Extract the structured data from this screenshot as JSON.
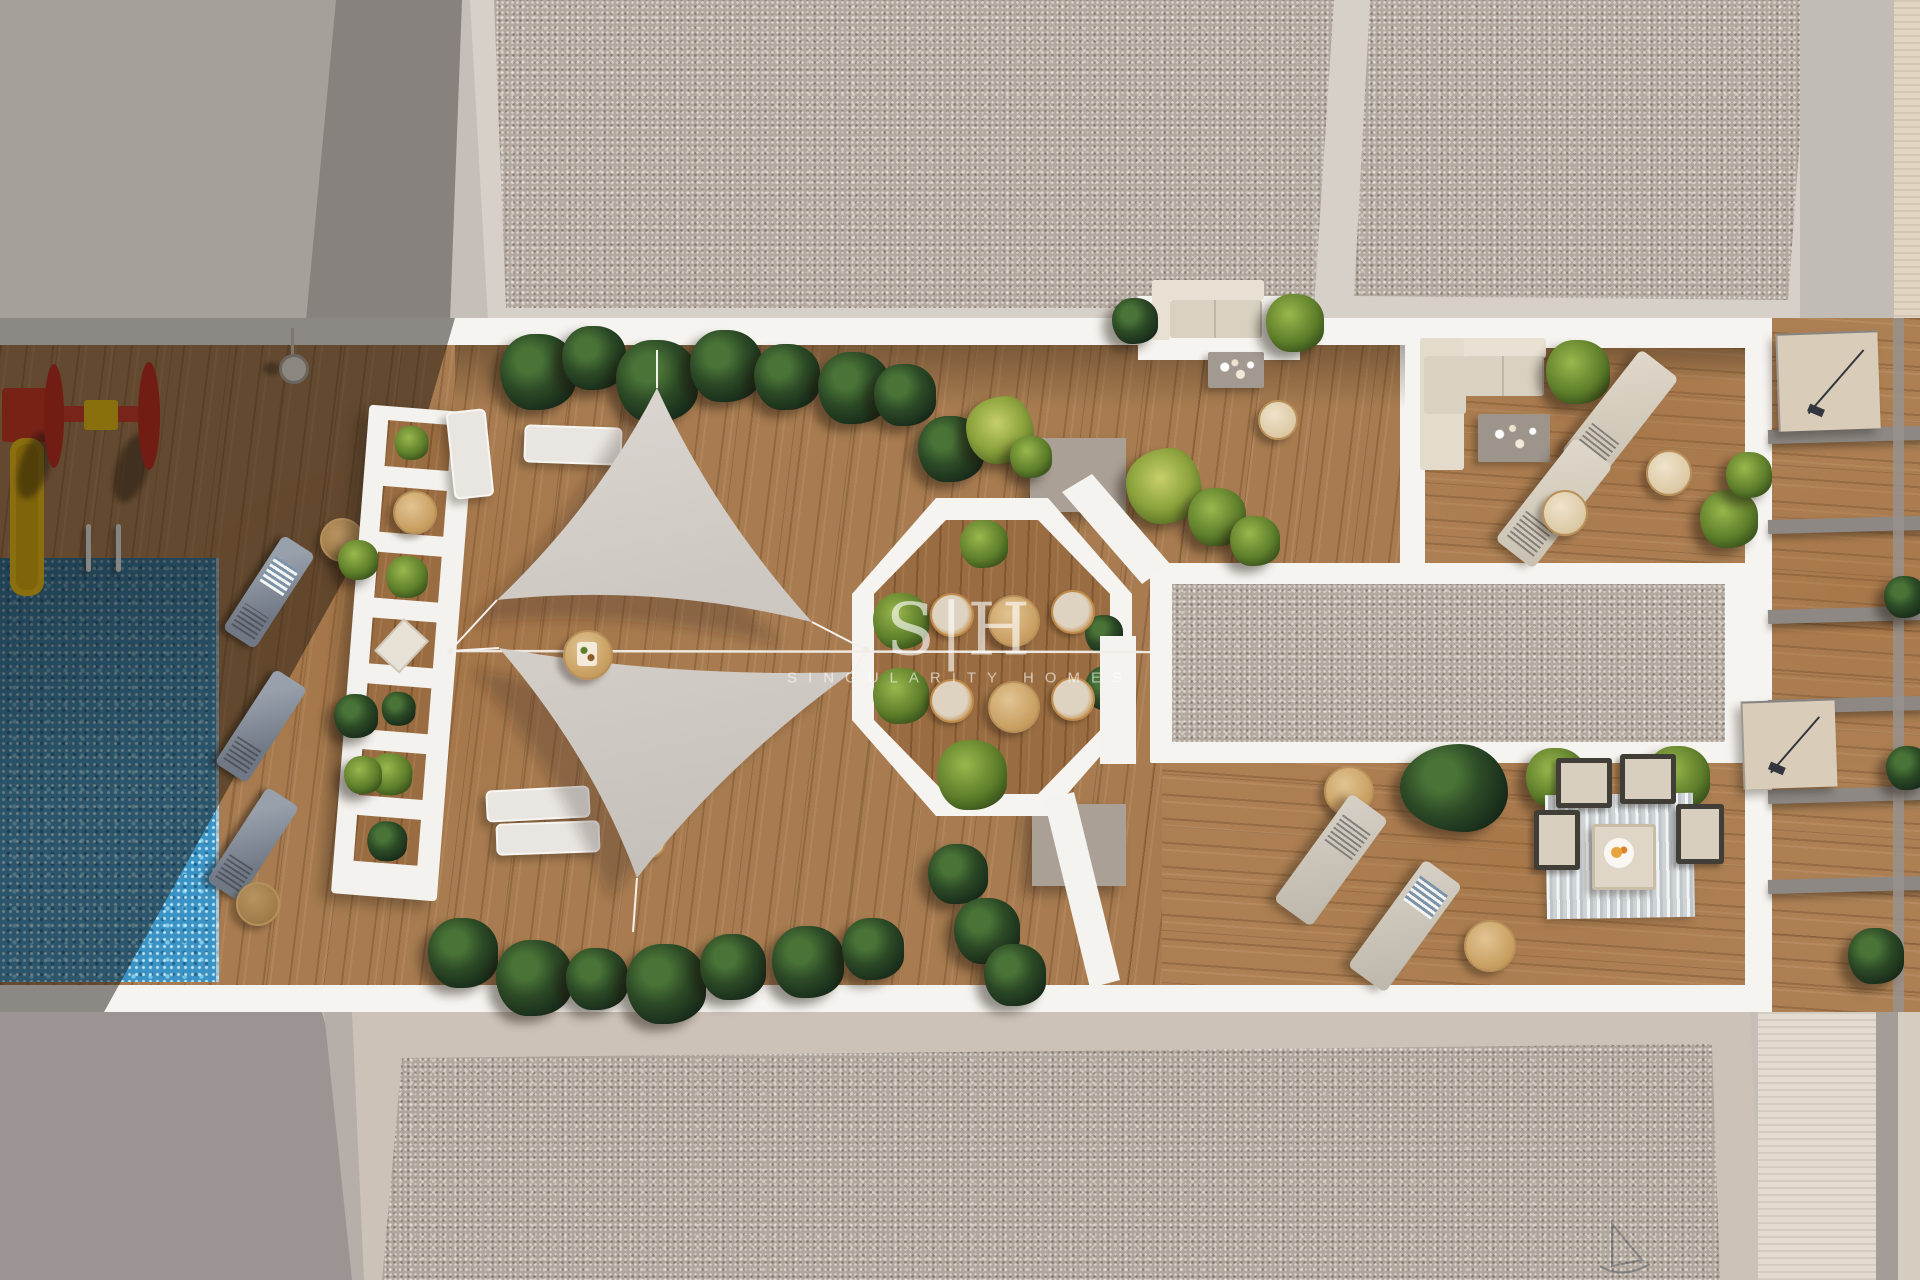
{
  "watermark": {
    "logo": "S|H",
    "brand": "SINGULARITY HOMES"
  },
  "palette": {
    "wood": "#a87c50",
    "wood-dark": "#9a6c41",
    "pool": "#3a93c4",
    "gravel": "#b4a99f",
    "gravel-pink": "#b1a69c",
    "terrace-white": "#f6f4f0",
    "sail": "#d5cfca",
    "gray-roof": "#a6a09b",
    "gray-wall": "#9b9492",
    "divider": "#8d8884",
    "plant-dark": "#2c4a26",
    "plant-bright": "#5d7d2a",
    "accent-red": "#d0301f",
    "accent-yellow": "#f2c313",
    "furniture-beige": "#d8d0c0",
    "table-tan": "#d2a968"
  },
  "scene": {
    "description": "Aerial 3D render of a rooftop community terrace: swimming pool, kids playground, sun loungers, twin shade sails, octagonal dining patio, gravel solarium and private roof terraces.",
    "amenities": [
      "swimming-pool",
      "playground",
      "sun-loungers",
      "shade-sails",
      "octagonal-dining-patio",
      "lounge-areas",
      "solarium",
      "private-terraces"
    ]
  }
}
